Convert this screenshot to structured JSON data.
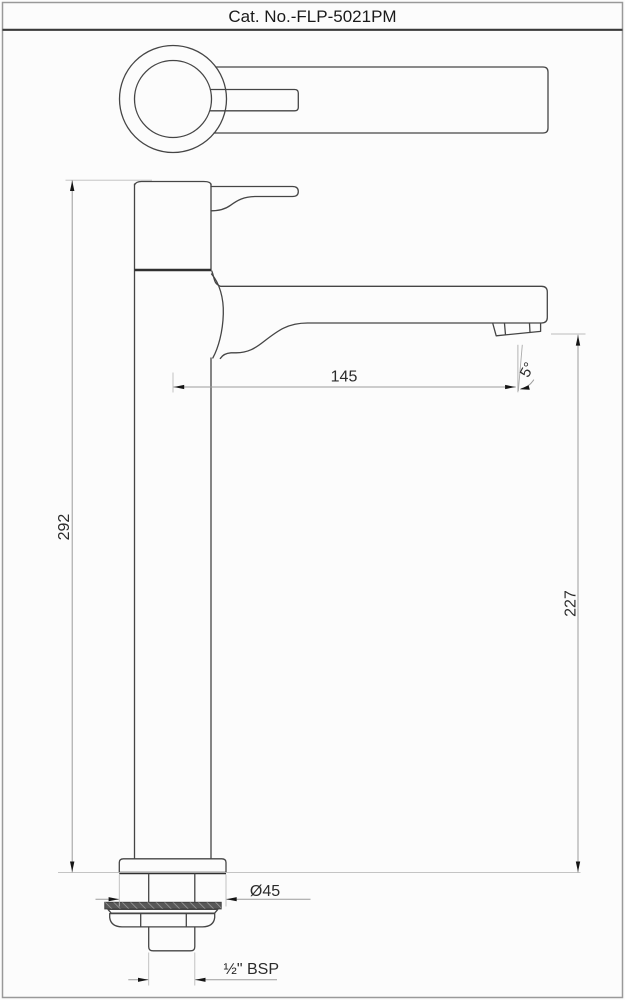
{
  "title": "Cat. No.-FLP-5021PM",
  "dimensions": {
    "overall_height": "292",
    "spout_reach": "145",
    "spout_height": "227",
    "spout_angle": "5°",
    "base_diameter": "Ø45",
    "inlet_thread": "½\" BSP"
  },
  "colors": {
    "background": "#fcfcfc",
    "outline": "#454545",
    "dim_line": "#9b9b9b",
    "ext_line": "#bcbcbc",
    "arrow": "#151515",
    "text": "#2b2b2b",
    "border": "#999999",
    "separator": "#3a3a3a",
    "washer_fill": "#575757"
  }
}
